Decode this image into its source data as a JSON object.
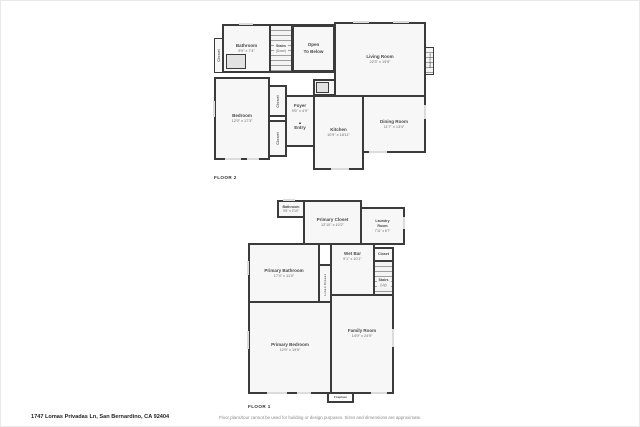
{
  "colors": {
    "wall": "#3b3b3b",
    "room_fill": "#f7f7f7",
    "window": "#dcdcdc",
    "text": "#474747"
  },
  "floor2": {
    "label": "FLOOR 2",
    "closet_left": {
      "name": "Closet"
    },
    "bathroom": {
      "name": "Bathroom",
      "dims": "9'9\" x 7'4\""
    },
    "stairs": {
      "name": "Stairs",
      "sub": "(Down)"
    },
    "open_to_below": {
      "line1": "Open",
      "line2": "To Below"
    },
    "living_room": {
      "name": "Living Room",
      "dims": "22'3\" x 19'5\""
    },
    "staircase": {
      "name": "Staircase"
    },
    "bedroom": {
      "name": "Bedroom",
      "dims": "12'9\" x 17'3\""
    },
    "closet_a": {
      "name": "Closet"
    },
    "closet_b": {
      "name": "Closet"
    },
    "foyer": {
      "name": "Foyer",
      "dims": "9'5\" x 4'9\""
    },
    "entry": {
      "name": "Entry",
      "arrow": "▲"
    },
    "kitchen": {
      "name": "Kitchen",
      "dims": "10'9\" x 18'11\""
    },
    "dining_room": {
      "name": "Dining Room",
      "dims": "11'7\" x 13'4\""
    }
  },
  "floor1": {
    "label": "FLOOR 1",
    "bathroom": {
      "name": "Bathroom",
      "dims": "9'6\" x 2'10\""
    },
    "primary_closet": {
      "name": "Primary Closet",
      "dims": "12'10\" x 10'2\""
    },
    "laundry_room": {
      "name": "Laundry Room",
      "dims": "7'11\" x 8'7\""
    },
    "wet_bar": {
      "name": "Wet Bar",
      "dims": "9'1\" x 10'1\""
    },
    "closet_top": {
      "name": "Closet"
    },
    "stairs": {
      "name": "Stairs",
      "sub": "(Up)"
    },
    "primary_bathroom": {
      "name": "Primary Bathroom",
      "dims": "17'4\" x 11'0\""
    },
    "linen_closet": {
      "name": "Linen Closet"
    },
    "primary_bedroom": {
      "name": "Primary Bedroom",
      "dims": "12'9\" x 19'5\""
    },
    "family_room": {
      "name": "Family Room",
      "dims": "14'9\" x 24'9\""
    },
    "fireplace": {
      "name": "Fireplace"
    }
  },
  "footer": {
    "address": "1747 Lomas Privadas Ln, San Bernardino, CA 92404",
    "disclaimer": "Floor plans/tour cannot be used for building or design purposes. Sizes and dimensions are approximate."
  }
}
